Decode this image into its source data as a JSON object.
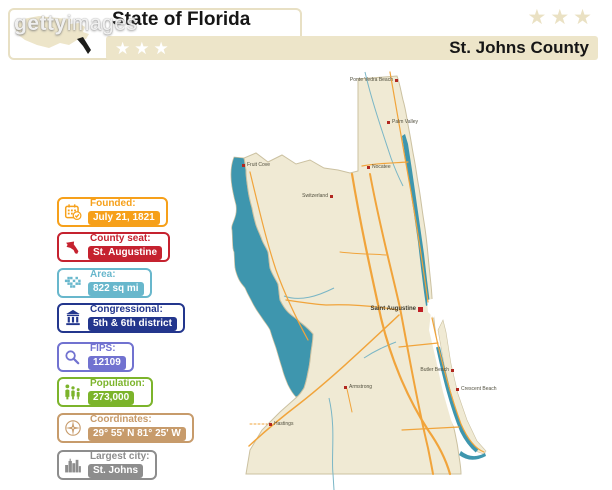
{
  "watermark": {
    "bold": "getty",
    "light": "images"
  },
  "header": {
    "state_title": "State of Florida",
    "county_title": "St. Johns County",
    "left_stars": "★★★",
    "right_stars": "★★★"
  },
  "badges": [
    {
      "id": "founded",
      "title": "Founded:",
      "value": "July 21, 1821",
      "color": "#F6A01A",
      "icon": "calendar-icon"
    },
    {
      "id": "county-seat",
      "title": "County seat:",
      "value": "St. Augustine",
      "color": "#C5222F",
      "icon": "florida-icon"
    },
    {
      "id": "area",
      "title": "Area:",
      "value": "822 sq mi",
      "color": "#68B7CC",
      "icon": "pixel-map-icon"
    },
    {
      "id": "congressional",
      "title": "Congressional:",
      "value": "5th & 6th district",
      "color": "#23368D",
      "icon": "capitol-icon"
    },
    {
      "id": "fips",
      "title": "FIPS:",
      "value": "12109",
      "color": "#7172D0",
      "icon": "magnifier-icon"
    },
    {
      "id": "population",
      "title": "Population:",
      "value": "273,000",
      "color": "#7CB42B",
      "icon": "family-icon"
    },
    {
      "id": "coordinates",
      "title": "Coordinates:",
      "value": "29° 55' N 81° 25' W",
      "color": "#C79B6B",
      "icon": "compass-icon"
    },
    {
      "id": "largest-city",
      "title": "Largest city:",
      "value": "St. Johns",
      "color": "#8D8D8D",
      "icon": "skyline-icon"
    }
  ],
  "map": {
    "colors": {
      "land": "#F0EAD4",
      "water": "#3E96AE",
      "road_major": "#F1A43B",
      "road_minor": "#F2B65F",
      "creek": "#7AB6C6",
      "border": "#CBC1A1",
      "marker": "#B1271F"
    },
    "towns": [
      {
        "name": "Ponte Vedra Beach",
        "x": 396,
        "y": 81,
        "text_side": "left",
        "seat": false
      },
      {
        "name": "Palm Valley",
        "x": 389,
        "y": 123,
        "text_side": "right",
        "seat": false
      },
      {
        "name": "Nocatee",
        "x": 369,
        "y": 168,
        "text_side": "right",
        "seat": false
      },
      {
        "name": "Fruit Cove",
        "x": 244,
        "y": 166,
        "text_side": "right",
        "seat": false
      },
      {
        "name": "Switzerland",
        "x": 331,
        "y": 197,
        "text_side": "left",
        "seat": false
      },
      {
        "name": "Saint Augustine",
        "x": 421,
        "y": 309,
        "text_side": "left",
        "seat": true
      },
      {
        "name": "Armstrong",
        "x": 346,
        "y": 388,
        "text_side": "right",
        "seat": false
      },
      {
        "name": "Hastings",
        "x": 271,
        "y": 425,
        "text_side": "right",
        "seat": false
      },
      {
        "name": "Butler Beach",
        "x": 452,
        "y": 371,
        "text_side": "left",
        "seat": false
      },
      {
        "name": "Crescent Beach",
        "x": 458,
        "y": 390,
        "text_side": "right",
        "seat": false
      }
    ]
  }
}
